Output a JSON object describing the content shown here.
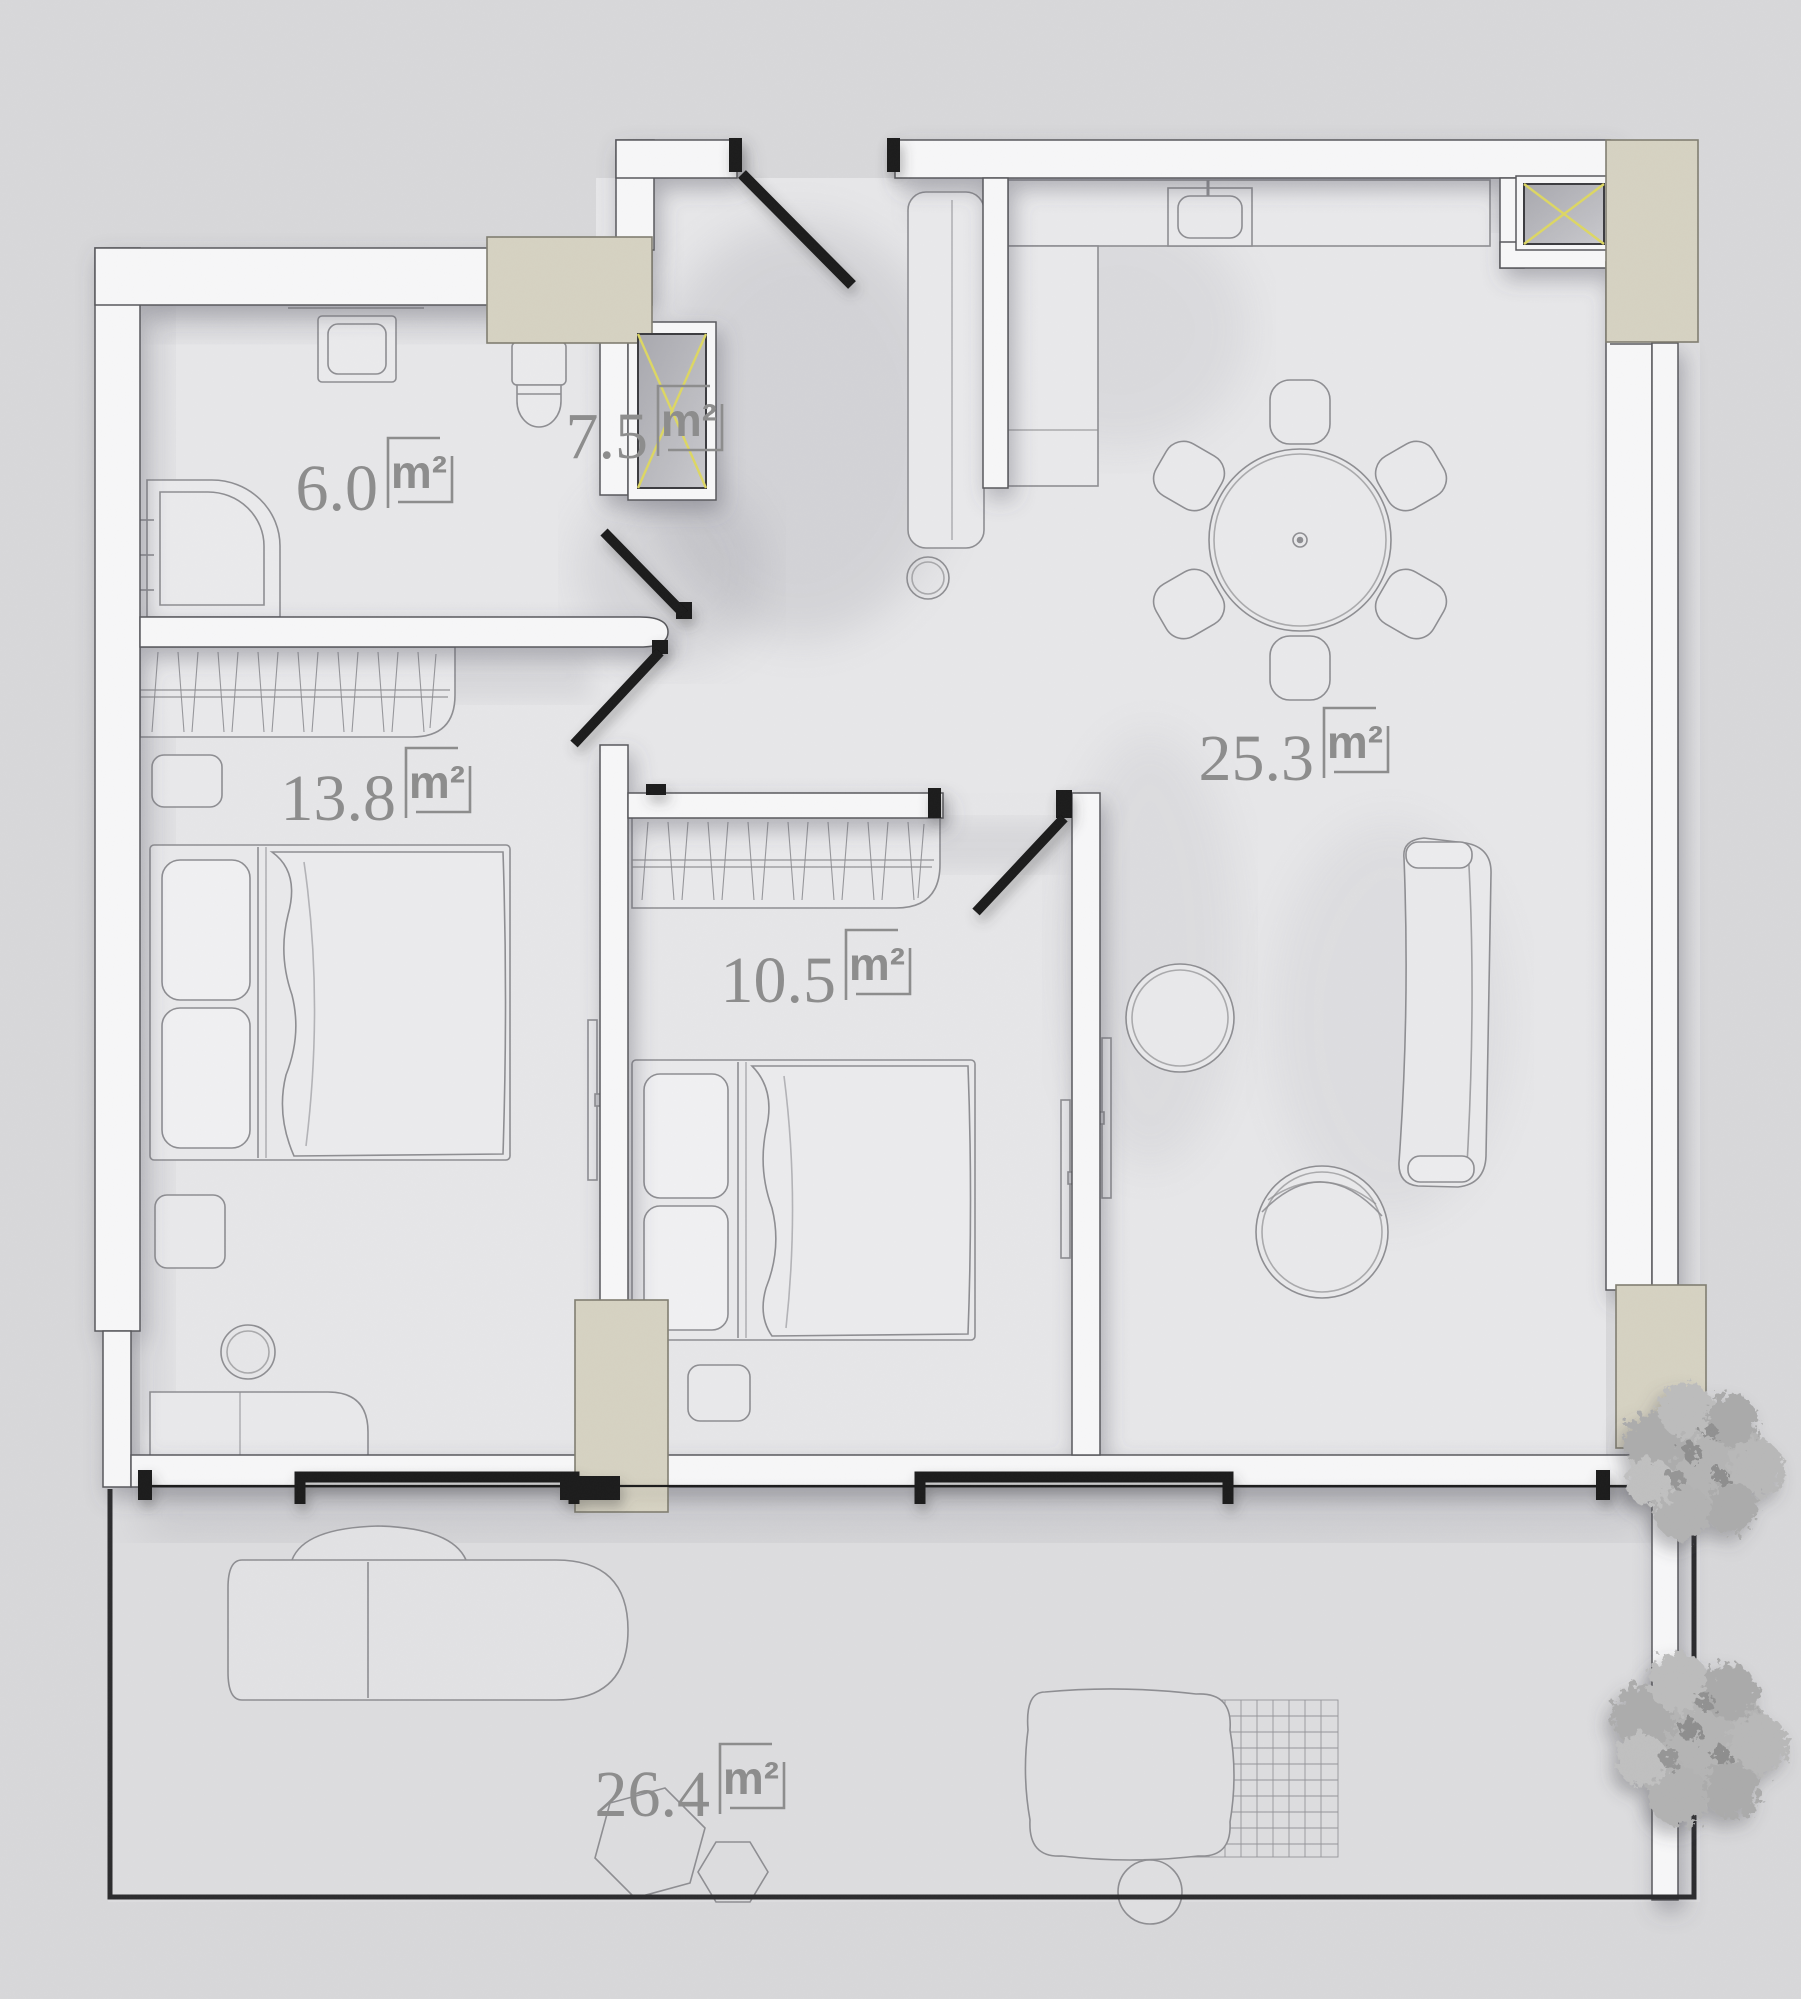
{
  "unit": "m²",
  "rooms": [
    {
      "name": "bathroom",
      "area": "6.0"
    },
    {
      "name": "hallway",
      "area": "7.5"
    },
    {
      "name": "bedroom-left",
      "area": "13.8"
    },
    {
      "name": "bedroom-middle",
      "area": "10.5"
    },
    {
      "name": "living-room",
      "area": "25.3"
    },
    {
      "name": "terrace",
      "area": "26.4"
    }
  ],
  "colors": {
    "background": "#d8d8da",
    "floor": "#e7e7e9",
    "terrace_floor": "#dddddf",
    "wall": "#f7f7f8",
    "wall_outline": "#58585c",
    "door_black": "#1a1a1a",
    "beige_block": "#d6d2c2",
    "shaft_yellow": "#ddd763",
    "label_gray": "#8d8d8d"
  }
}
